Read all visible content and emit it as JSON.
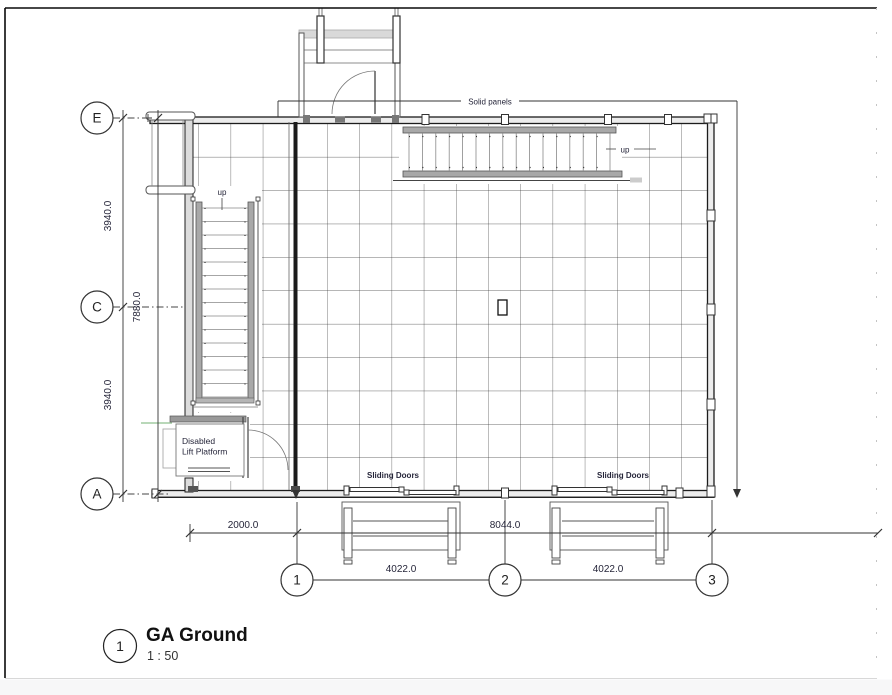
{
  "view": {
    "number": "1",
    "title": "GA Ground",
    "scale": "1 : 50"
  },
  "grid_bubbles": {
    "rows": [
      "E",
      "C",
      "A"
    ],
    "cols": [
      "1",
      "2",
      "3"
    ]
  },
  "dimensions": {
    "e_to_c": "3940.0",
    "c_to_a": "3940.0",
    "e_to_a": "7880.0",
    "west_offset": "2000.0",
    "grid1_to_grid3": "8044.0",
    "grid1_to_grid2": "4022.0",
    "grid2_to_grid3": "4022.0"
  },
  "labels": {
    "solid_panels": "Solid panels",
    "stair_left_up": "up",
    "stair_top_up": "up",
    "lift_line1": "Disabled",
    "lift_line2": "Lift Platform",
    "sliding_doors_left": "Sliding Doors",
    "sliding_doors_right": "Sliding Doors"
  },
  "colors": {
    "line": "#1a1a1a",
    "wall_fill": "#ececec",
    "stair_gray": "#a8a8a8",
    "accent_green": "#8fc08f"
  }
}
